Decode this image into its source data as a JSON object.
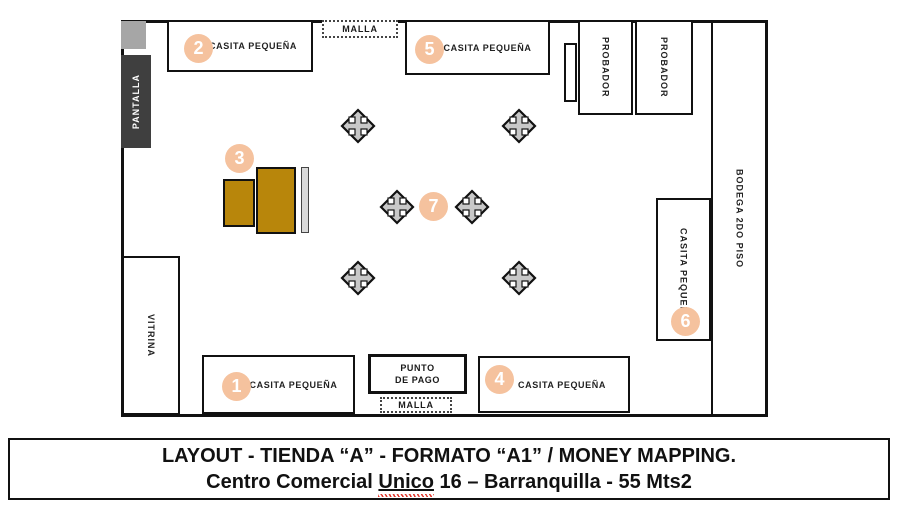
{
  "window": {
    "width": 900,
    "height": 510
  },
  "colors": {
    "accent_circle": "#f5c29e",
    "gold_table": "#b8860b",
    "dark_panel": "#3f3f3f",
    "light_gray": "#a6a6a6",
    "strip_gray": "#d9d9d9",
    "cross_gray": "#c8c8c8",
    "wall": "#111111"
  },
  "plan": {
    "pantalla_label": "PANTALLA",
    "vitrina_label": "VITRINA",
    "bodega_label": "BODEGA 2DO PISO",
    "probador1_label": "PROBADOR",
    "probador2_label": "PROBADOR",
    "malla_top_label": "MALLA",
    "malla_bottom_label": "MALLA",
    "punto_de_pago": {
      "line1": "PUNTO",
      "line2": "DE PAGO"
    },
    "casitas": [
      {
        "num": "1",
        "label": "CASITA PEQUEÑA"
      },
      {
        "num": "2",
        "label": "CASITA PEQUEÑA"
      },
      {
        "num": "4",
        "label": "CASITA PEQUEÑA"
      },
      {
        "num": "5",
        "label": "CASITA PEQUEÑA"
      },
      {
        "num": "6",
        "label": "CASITA PEQUEÑA"
      }
    ],
    "zone3_num": "3",
    "zone7_num": "7"
  },
  "caption": {
    "line1": "LAYOUT - TIENDA “A” - FORMATO “A1” / MONEY MAPPING.",
    "line2_prefix": "Centro Comercial ",
    "line2_underlined": "Unico",
    "line2_suffix": " 16 – Barranquilla - 55 Mts2"
  }
}
